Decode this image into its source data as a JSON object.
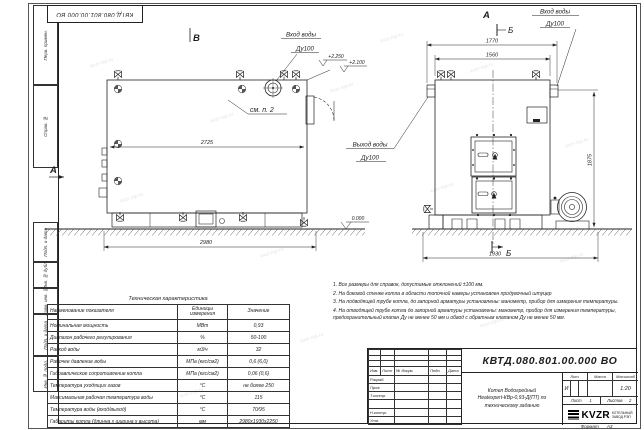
{
  "page": {
    "watermark": "kvzr-rep.ru",
    "format_label": "Формат",
    "format_value": "А3"
  },
  "frame": {
    "top_stamp": "КВТД.080.801.00.000  ВО",
    "margin_labels": [
      "Перв. примен.",
      "Справ. №",
      "Подп. и дата",
      "Инв. № дубл.",
      "Взам. инв. №",
      "Подп. и дата",
      "Инв. № подл."
    ]
  },
  "labels": {
    "view_b": "В",
    "view_a": "А",
    "view_a_arrow": "А",
    "section_b_top": "Б",
    "section_b_bottom": "Б",
    "see_note": "см. п. 2",
    "inlet_1": "Вход воды",
    "inlet_2": "Ду100",
    "outlet_1": "Выход воды",
    "outlet_2": "Ду100",
    "elev_2250": "+2.250",
    "elev_2100": "+2.100",
    "elev_0": "0.000"
  },
  "dims": {
    "d2725": "2725",
    "d2980": "2980",
    "d1770": "1770",
    "d1560": "1560",
    "d1930": "1930",
    "d1875": "1875"
  },
  "tech_table": {
    "title": "Техническая характеристика",
    "headers": [
      "Наименование показателя",
      "Единицы измерения",
      "Значение"
    ],
    "rows": [
      {
        "name": "Номинальная мощность",
        "unit": "МВт",
        "value": "0,93"
      },
      {
        "name": "Диапазон рабочего регулирования",
        "unit": "%",
        "value": "50-100"
      },
      {
        "name": "Расход воды",
        "unit": "м3/ч",
        "value": "32"
      },
      {
        "name": "Рабочее давление воды",
        "unit": "МПа (кгс/см2)",
        "value": "0,6 (6,0)"
      },
      {
        "name": "Гидравлическое сопротивление котла",
        "unit": "МПа (кгс/см2)",
        "value": "0,06 (0,6)"
      },
      {
        "name": "Температура уходящих газов",
        "unit": "°С",
        "value": "не более 250"
      },
      {
        "name": "Максимальная рабочая температура воды",
        "unit": "°С",
        "value": "115"
      },
      {
        "name": "Температура воды (вход/выход)",
        "unit": "°С",
        "value": "70/95"
      },
      {
        "name": "Габариты котла (длинна х ширина х высота)",
        "unit": "мм",
        "value": "2980х1930х2250"
      }
    ]
  },
  "notes": {
    "items": [
      "1. Все размеры для справок, допустимые отклонений ±100 мм.",
      "2. На боковой стенке котла в области топочной камеры установлен продувочный штуцер",
      "3. На подводящей трубе котла, до запорной арматуры установлены: манометр, прибор для измерения температуры.",
      "4. На отводящей трубе котла до запорной арматуры установлены: манометр, прибор для измерения температуры, предохранительный клапан Ду не менее 50 мм и обвод с обратным клапаном Ду не менее 50 мм."
    ]
  },
  "title_block": {
    "doc_number": "КВТД.080.801.00.000  ВО",
    "name_line1": "Котел Водогрейный",
    "name_line2": "Heatexpert-КВр-0,93-Д(ПТ) по",
    "name_line3": "техническому заданию",
    "header": [
      "Изм.",
      "Лист",
      "№ докум.",
      "Подп.",
      "Дата"
    ],
    "roles": [
      "Разраб.",
      "Пров.",
      "Т.контр.",
      "",
      "Н.контр.",
      "Утв."
    ],
    "lit_label": "Лит.",
    "lit_value": "И",
    "mass_label": "Масса",
    "mass_value": "",
    "scale_label": "Масштаб",
    "scale_value": "1:20",
    "sheet_label": "Лист",
    "sheet_value": "1",
    "sheets_label": "Листов",
    "sheets_value": "2",
    "logo_text": "KVZR",
    "logo_caption_1": "КОТЕЛЬНЫЙ",
    "logo_caption_2": "ЗАВОД РЭП"
  }
}
